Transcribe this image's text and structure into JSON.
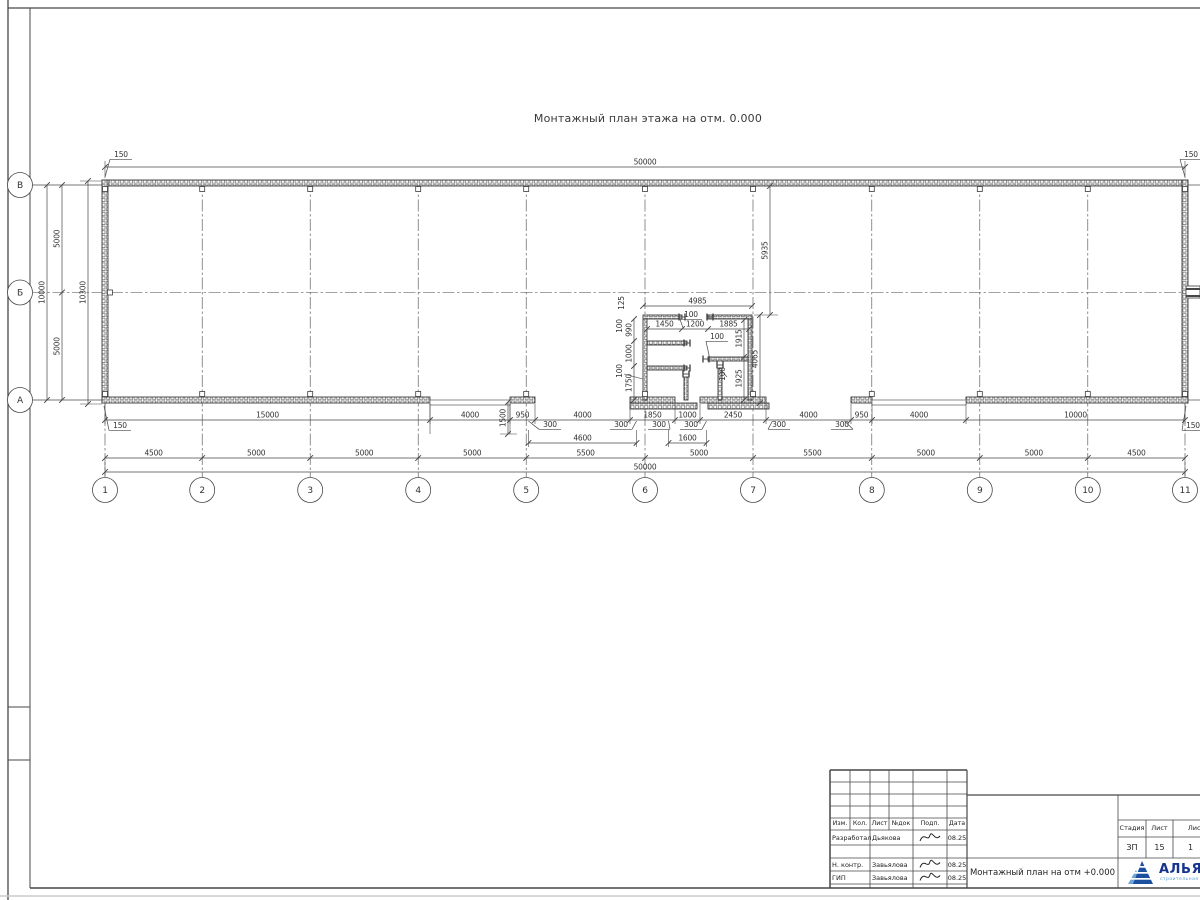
{
  "sheet": {
    "drawing_title": "Монтажный план этажа на отм. 0.000"
  },
  "axes": {
    "cols": [
      "1",
      "2",
      "3",
      "4",
      "5",
      "6",
      "7",
      "8",
      "9",
      "10",
      "11"
    ],
    "col_spacings_mm": [
      4500,
      5000,
      5000,
      5000,
      5500,
      5000,
      5500,
      5000,
      5000,
      4500
    ],
    "rows": [
      "В",
      "Б",
      "А"
    ],
    "row_spacings_mm": [
      5000,
      5000
    ]
  },
  "dims": {
    "top_total": "50000",
    "bottom_total": "50000",
    "bottom_chain": [
      "4500",
      "5000",
      "5000",
      "5000",
      "5500",
      "5000",
      "5500",
      "5000",
      "5000",
      "4500"
    ],
    "bottom_row1": [
      "15000",
      "4000",
      "950",
      "4000",
      "1850",
      "1000",
      "2450",
      "4000",
      "950",
      "4000",
      "10000"
    ],
    "door_clear": [
      "4600",
      "1600"
    ],
    "left_chain": [
      "5000",
      "5000"
    ],
    "left_total": "10000",
    "left_overall": "10300",
    "corner_offsets": [
      "150",
      "150",
      "150",
      "150"
    ],
    "jamb_offsets": [
      "300",
      "300",
      "300",
      "300",
      "300",
      "300"
    ],
    "dock_depth": "1500",
    "room_offset_top": "5935"
  },
  "room": {
    "top_width": "4985",
    "top_chain": [
      "1450",
      "1200",
      "1885"
    ],
    "left_stack": [
      "125",
      "100",
      "990",
      "1000",
      "100",
      "1750"
    ],
    "right_stack": [
      "1915",
      "1925",
      "4065",
      "100"
    ],
    "wall_thk": [
      "100",
      "100"
    ]
  },
  "titleblock": {
    "header_cols": [
      "Изм.",
      "Кол.",
      "Лист",
      "№док",
      "Подп.",
      "Дата"
    ],
    "rows": [
      {
        "role": "Разработал",
        "name": "Дьякова",
        "date": "08.25"
      },
      {
        "role": "",
        "name": "",
        "date": ""
      },
      {
        "role": "Н. контр.",
        "name": "Завьялова",
        "date": "08.25"
      },
      {
        "role": "ГИП",
        "name": "Завьялова",
        "date": "08.25"
      }
    ],
    "doc_title": "Монтажный план на отм +0.000",
    "stage_cols": [
      "Стадия",
      "Лист",
      "Листов"
    ],
    "stage_vals": [
      "ЗП",
      "15",
      "1"
    ],
    "company_name": "АЛЬЯНС",
    "company_tagline": "строительная компания"
  },
  "colors": {
    "line": "#474747",
    "logo_blue": "#1c4f9e",
    "logo_text": "#16338e",
    "logo_sub": "#5b9bd5"
  }
}
